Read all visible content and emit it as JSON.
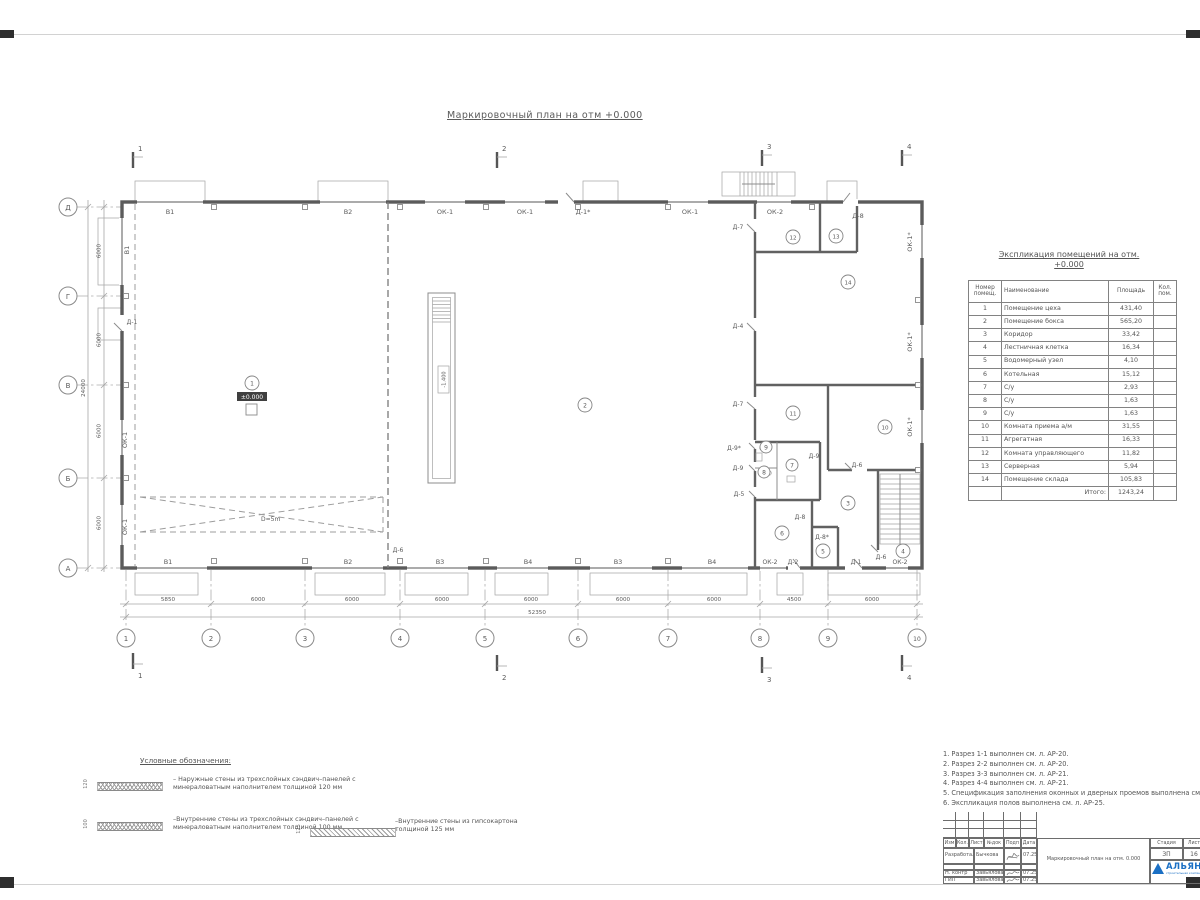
{
  "sheet": {
    "title": "Маркировочный план на отм +0.000"
  },
  "plan": {
    "section_marks": [
      "1",
      "2",
      "3",
      "4"
    ],
    "axes_bottom": [
      "1",
      "2",
      "3",
      "4",
      "5",
      "6",
      "7",
      "8",
      "9",
      "10"
    ],
    "axes_left": [
      "Д",
      "Г",
      "В",
      "Б",
      "А"
    ],
    "dims_bottom": [
      "5850",
      "6000",
      "6000",
      "6000",
      "6000",
      "6000",
      "6000",
      "4500",
      "6000"
    ],
    "dims_bottom_total": "52350",
    "dims_left": [
      "6000",
      "6000",
      "6000",
      "6000"
    ],
    "dims_left_total": "24000",
    "top_labels": [
      "В1",
      "В2",
      "ОК-1",
      "ОК-1",
      "Д-1*",
      "ОК-1",
      "ОК-2",
      "Д-8"
    ],
    "bottom_labels": [
      "В1",
      "В2",
      "В3",
      "В4",
      "В3",
      "В4",
      "ОК-2",
      "Д-2",
      "Д-1",
      "Д-6",
      "ОК-2"
    ],
    "left_labels": [
      "В1",
      "Д-1",
      "ОК-1",
      "ОК-1"
    ],
    "right_labels": [
      "ОК-1*",
      "ОК-1*",
      "ОК-1*"
    ],
    "door_labels": [
      "Д-7",
      "Д-4",
      "Д-7",
      "Д-9*",
      "Д-9",
      "Д-5",
      "Д-9",
      "Д-6",
      "Д-8",
      "Д-8*",
      "Д-6"
    ],
    "rooms": [
      "1",
      "2",
      "3",
      "4",
      "5",
      "6",
      "7",
      "8",
      "9",
      "10",
      "11",
      "12",
      "13",
      "14"
    ],
    "elevation_zero": "±0.000",
    "pit_elevation": "-1.400",
    "crane_zone_label": "D=5m"
  },
  "schedule": {
    "title_line1": "Экспликация помещений на отм.",
    "title_line2": "+0.000",
    "headers": [
      "Номер помещ.",
      "Наименование",
      "Площадь",
      "Кол. пом."
    ],
    "rows": [
      {
        "num": "1",
        "name": "Помещение цеха",
        "area": "431,40"
      },
      {
        "num": "2",
        "name": "Помещение бокса",
        "area": "565,20"
      },
      {
        "num": "3",
        "name": "Коридор",
        "area": "33,42"
      },
      {
        "num": "4",
        "name": "Лестничная клетка",
        "area": "16,34"
      },
      {
        "num": "5",
        "name": "Водомерный узел",
        "area": "4,10"
      },
      {
        "num": "6",
        "name": "Котельная",
        "area": "15,12"
      },
      {
        "num": "7",
        "name": "С/у",
        "area": "2,93"
      },
      {
        "num": "8",
        "name": "С/у",
        "area": "1,63"
      },
      {
        "num": "9",
        "name": "С/у",
        "area": "1,63"
      },
      {
        "num": "10",
        "name": "Комната приема а/м",
        "area": "31,55"
      },
      {
        "num": "11",
        "name": "Агрегатная",
        "area": "16,33"
      },
      {
        "num": "12",
        "name": "Комната управляющего",
        "area": "11,82"
      },
      {
        "num": "13",
        "name": "Серверная",
        "area": "5,94"
      },
      {
        "num": "14",
        "name": "Помещение склада",
        "area": "105,83"
      }
    ],
    "total_label": "Итого:",
    "total_value": "1243,24"
  },
  "legend": {
    "title": "Условные обозначения:",
    "items": [
      {
        "dim": "120",
        "text": "– Наружные стены из трехслойных сэндвич–панелей с минераловатным наполнителем толщиной 120 мм"
      },
      {
        "dim": "100",
        "text": "–Внутренние стены из трехслойных сэндвич–панелей с минераловатным наполнителем толщиной 100 мм"
      },
      {
        "dim": "125",
        "text": "–Внутренние стены из гипсокартона толщиной 125 мм"
      }
    ]
  },
  "notes": {
    "items": [
      "1. Разрез 1-1 выполнен см. л. АР-20.",
      "2. Разрез 2-2 выполнен см. л. АР-20.",
      "3. Разрез 3-3 выполнен см. л. АР-21.",
      "4. Разрез 4-4 выполнен см. л. АР-21.",
      "5. Спецификация заполнения оконных и дверных проемов выполнена см. л. АР-23, АР-24.",
      "6. Экспликация полов выполнена см. л. АР-25."
    ]
  },
  "titleblock": {
    "header_cells": [
      "Изм",
      "Кол.",
      "Лист",
      "№док",
      "Подп",
      "Дата"
    ],
    "rows": [
      {
        "role": "Разработал",
        "name": "Бычкова",
        "date": "07.25"
      },
      {
        "role": "Н. контр",
        "name": "Завьялова",
        "date": "07.25"
      },
      {
        "role": "ГИП",
        "name": "Завьялова",
        "date": "07.25"
      }
    ],
    "doc_title": "Маркировочный план на отм. 0.000",
    "stage_label": "Стадия",
    "sheet_label": "Лист",
    "stage_value": "ЗП",
    "sheet_value": "16",
    "logo_text": "АЛЬЯНС",
    "logo_subtext": "строительная компания",
    "logo_color": "#1a6fc4"
  }
}
